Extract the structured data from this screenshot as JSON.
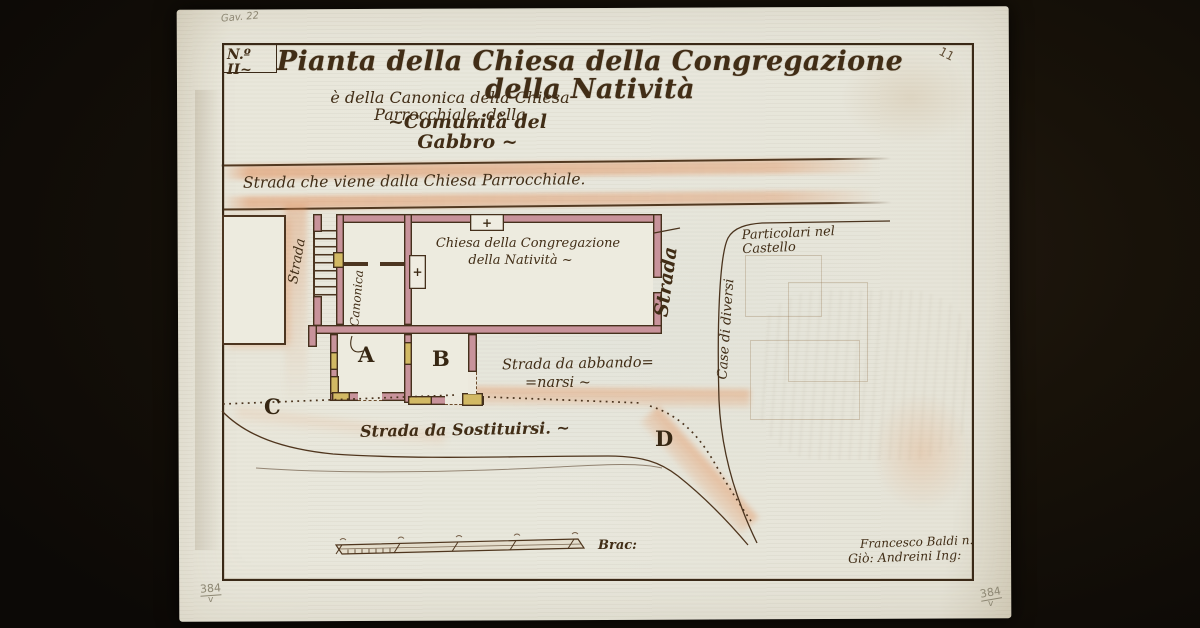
{
  "plate": {
    "number": "N.º II~",
    "pencil_top_left": "Gav. 22",
    "pencil_top_right": "11",
    "stamp_bottom_left": "384",
    "stamp_bottom_left_mark": "v",
    "stamp_bottom_right": "384",
    "stamp_bottom_right_mark": "v"
  },
  "title": {
    "line1": "Pianta della Chiesa della Congregazione della Natività",
    "line2": "è della Canonica della Chiesa Parrocchiale, della",
    "line3": "~Comunità del Gabbro ~"
  },
  "map": {
    "road_top": "Strada che viene dalla Chiesa Parrocchiale.",
    "strada_left": "Strada",
    "strada_right": "Strada",
    "canonica": "Canonica",
    "church_line1": "Chiesa della Congregazione",
    "church_line2": "della Natività ~",
    "room_a": "A",
    "room_b": "B",
    "point_c": "C",
    "point_d": "D",
    "road_abandon_1": "Strada da abbando=",
    "road_abandon_2": "=narsi ~",
    "road_substitute": "Strada da Sostituirsi. ~",
    "castle_side": "Case di diversi",
    "castle_top": "Particolari nel Castello",
    "cross": "+"
  },
  "scale": {
    "unit": "Brac:"
  },
  "signature": {
    "line1": "Francesco Baldi n.",
    "line2": "Giò: Andreini Ing:"
  },
  "colors": {
    "paper": "#e9e7db",
    "ink": "#412d16",
    "wall_pink": "#c8939b",
    "wall_yellow": "#d2b964",
    "road_wash": "#e09063",
    "background": "#16100b",
    "pencil": "#8d8773"
  }
}
